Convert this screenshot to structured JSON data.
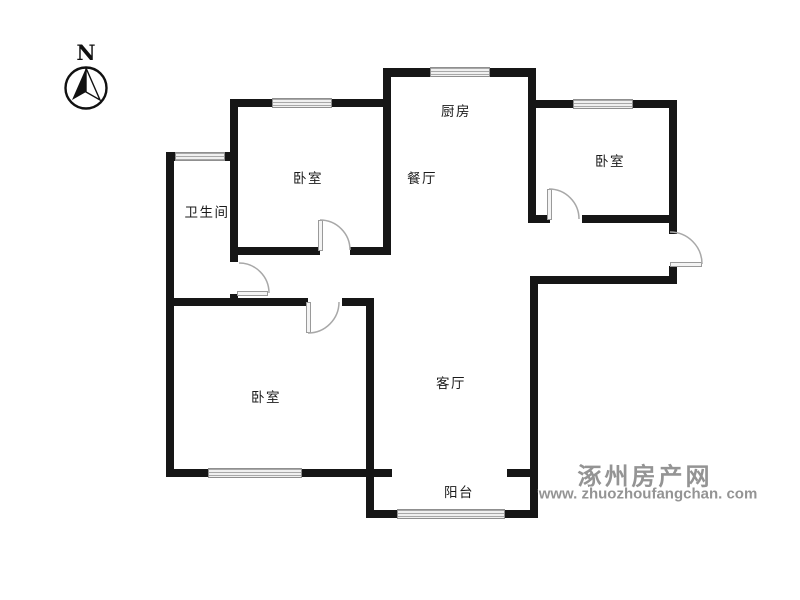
{
  "compass": {
    "north_label": "N"
  },
  "rooms": {
    "kitchen": "厨房",
    "dining": "餐厅",
    "living": "客厅",
    "balcony": "阳台",
    "bathroom": "卫生间",
    "bedroom_top_left": "卧室",
    "bedroom_top_right": "卧室",
    "bedroom_bottom_left": "卧室"
  },
  "watermark": {
    "site_name": "涿州房产网",
    "site_url": "www. zhuozhoufangchan. com"
  },
  "colors": {
    "wall": "#161616",
    "door_arc": "#a8a8a8",
    "window_stripe": "#a8a8a8",
    "watermark": "#949494",
    "background": "#ffffff"
  }
}
